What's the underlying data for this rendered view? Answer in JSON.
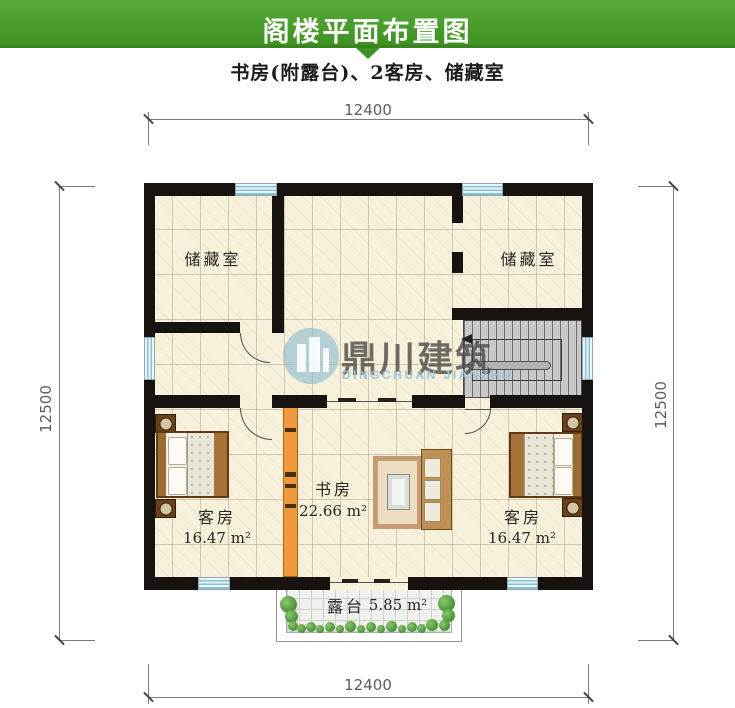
{
  "header": {
    "title": "阁楼平面布置图",
    "subtitle": "书房(附露台)、2客房、储藏室"
  },
  "dimensions": {
    "top": "12400",
    "bottom": "12400",
    "left": "12500",
    "right": "12500"
  },
  "rooms": {
    "storage_left": {
      "label": "储藏室"
    },
    "storage_right": {
      "label": "储藏室"
    },
    "guest_left": {
      "label": "客房",
      "area": "16.47 m²"
    },
    "guest_right": {
      "label": "客房",
      "area": "16.47 m²"
    },
    "study": {
      "label": "书房",
      "area": "22.66 m²"
    },
    "terrace": {
      "label": "露台",
      "area": "5.85 m²"
    }
  },
  "watermark": {
    "cn": "鼎川建筑",
    "en": "DINGCHUAN JIANZHU"
  },
  "colors": {
    "header_green": "#4a9e2c",
    "wall": "#171310",
    "floor_tile": "#f7f0da",
    "window_blue": "#86bfd4",
    "cabinet_orange": "#f09a3d",
    "stair_gray": "#c8c8c8",
    "plant_green": "#49913a"
  }
}
